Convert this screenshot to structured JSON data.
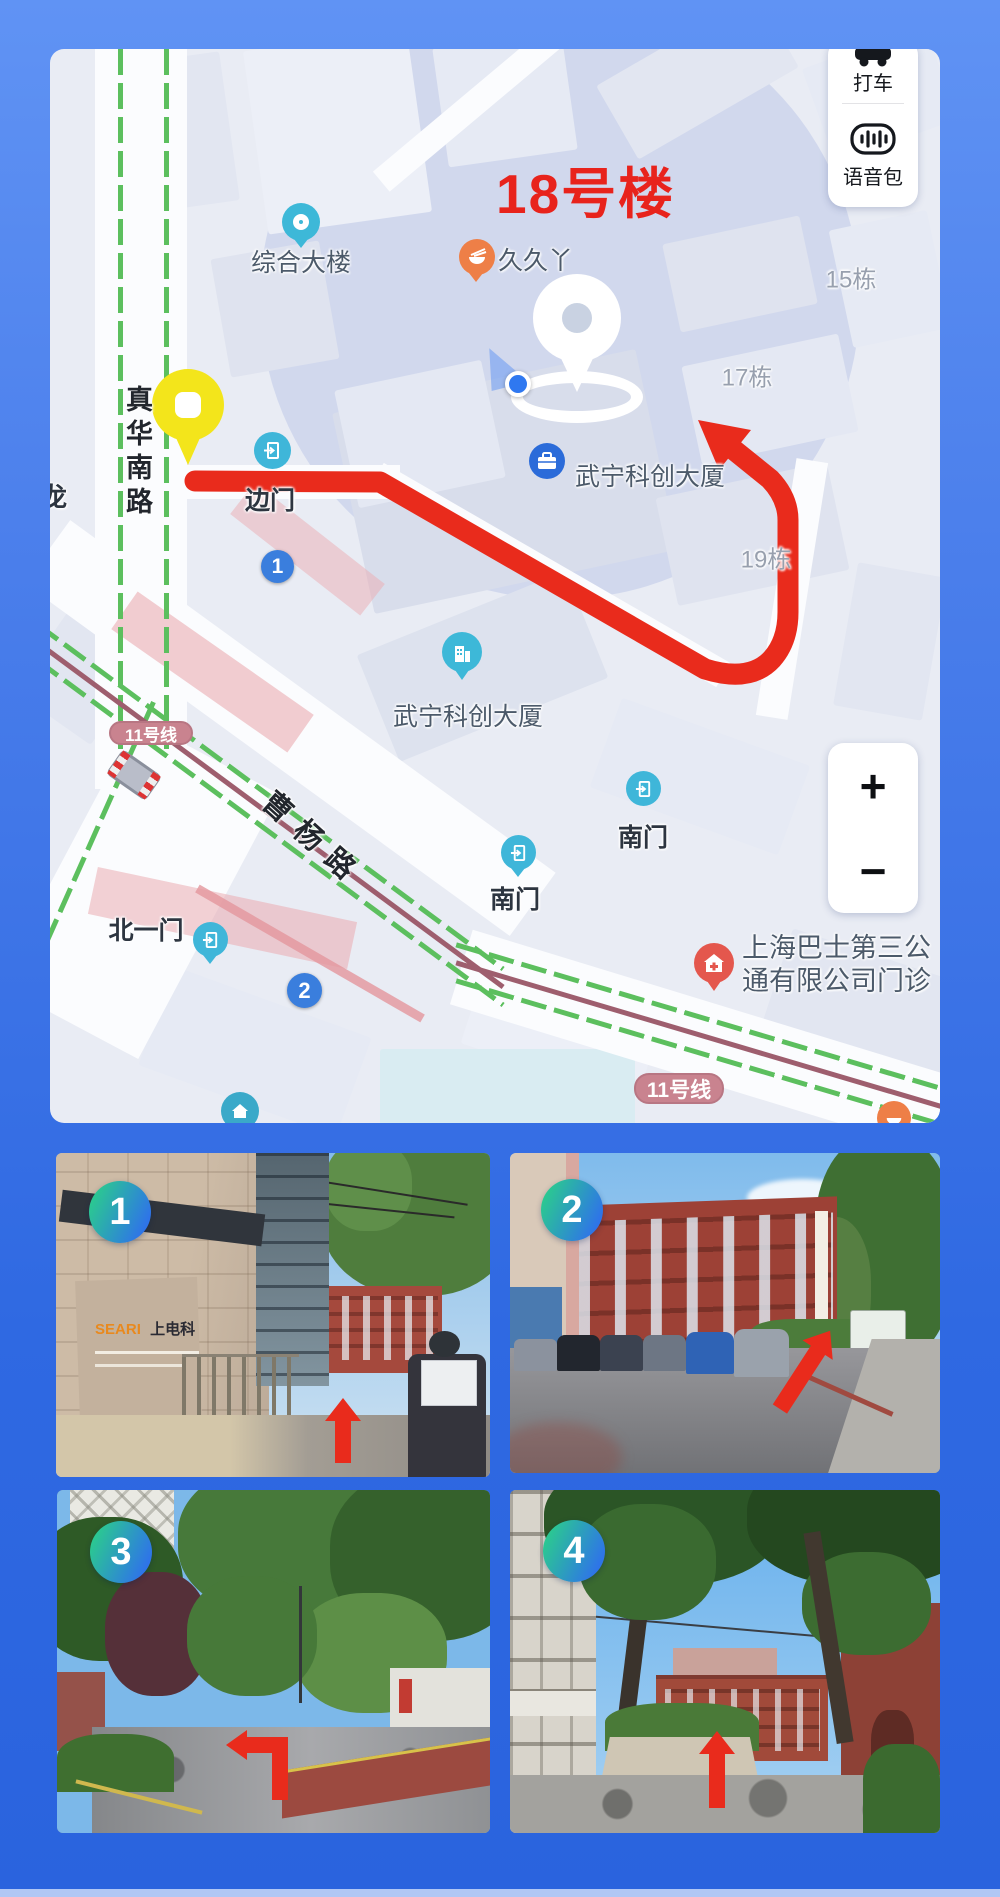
{
  "map": {
    "annotation": {
      "text": "18号楼",
      "color": "#e8231c"
    },
    "controls": {
      "taxi": {
        "label": "打车"
      },
      "voice_pack": {
        "label": "语音包"
      },
      "zoom_in": "+",
      "zoom_out": "−"
    },
    "route_color": "#e92b1c",
    "transit_badges": [
      {
        "text": "11号线"
      },
      {
        "text": "11号线"
      }
    ],
    "exit_markers": [
      {
        "text": "1"
      },
      {
        "text": "2"
      }
    ],
    "roads": [
      {
        "text": "真华南路"
      },
      {
        "text": "曹杨路"
      }
    ],
    "pois": [
      {
        "text": "综合大楼",
        "icon": "ring-pin"
      },
      {
        "text": "久久丫",
        "icon": "food-pin"
      },
      {
        "text": "15栋"
      },
      {
        "text": "17栋"
      },
      {
        "text": "19栋"
      },
      {
        "text": "武宁科创大厦",
        "icon": "briefcase-pin"
      },
      {
        "text": "武宁科创大厦",
        "icon": "building-pin"
      },
      {
        "text": "边门",
        "icon": "gate-pin"
      },
      {
        "text": "南门",
        "icon": "gate-pin"
      },
      {
        "text": "南门",
        "icon": "gate-pin"
      },
      {
        "text": "北一门",
        "icon": "gate-pin"
      },
      {
        "text": "上海巴士第三公",
        "icon": "hospital-pin"
      },
      {
        "text": "通有限公司门诊"
      },
      {
        "text": "龙"
      }
    ]
  },
  "photos": [
    {
      "number": "1",
      "sign_primary": "SEARI",
      "sign_secondary": "上电科"
    },
    {
      "number": "2"
    },
    {
      "number": "3"
    },
    {
      "number": "4"
    }
  ]
}
